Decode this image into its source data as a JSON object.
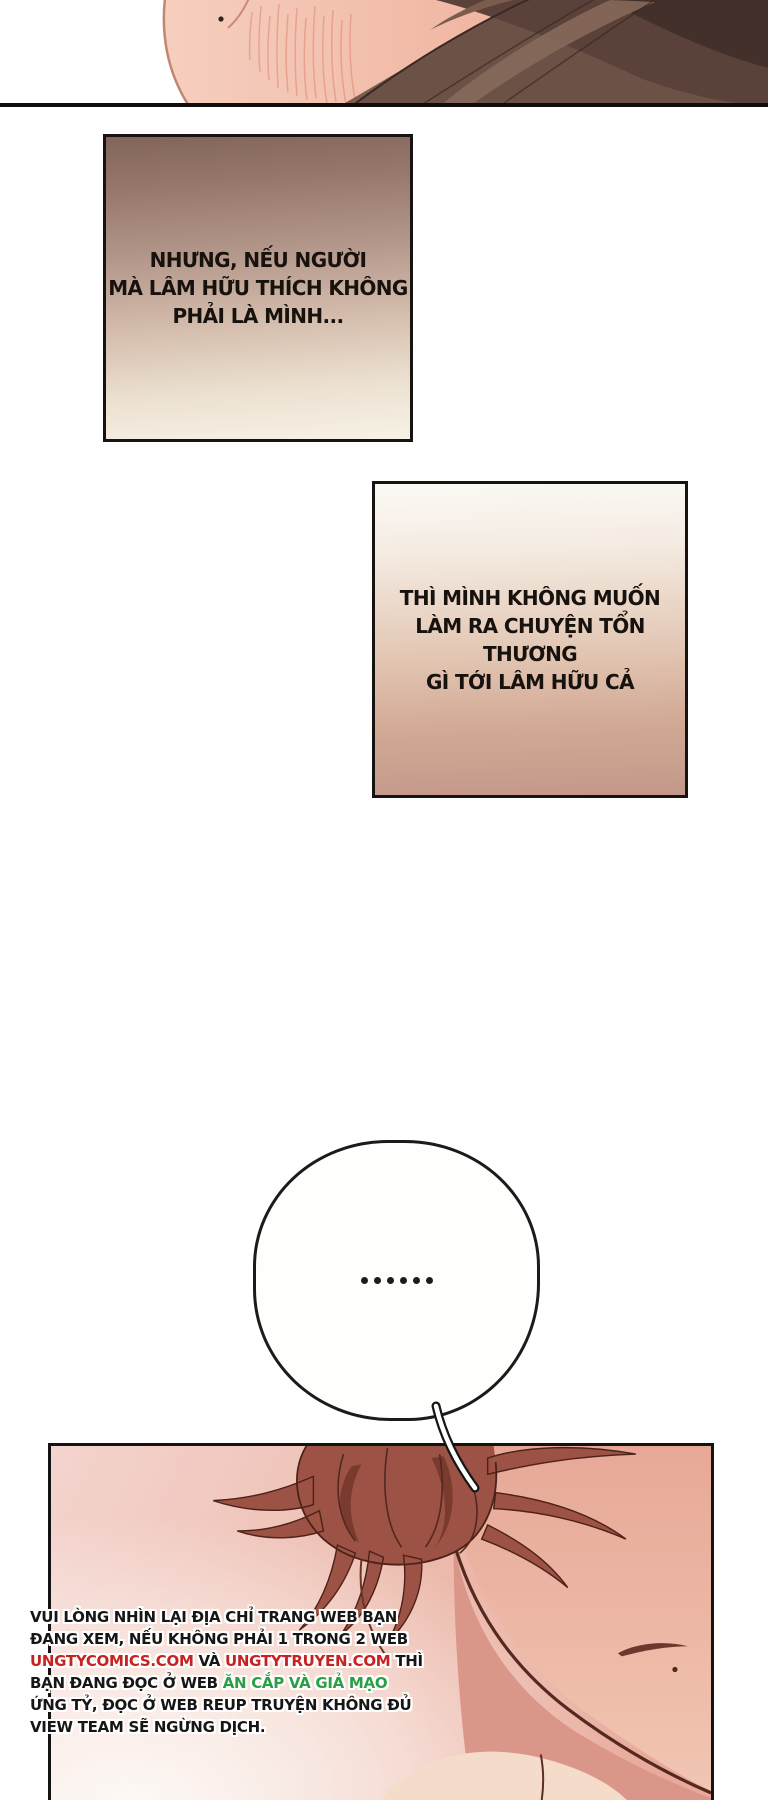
{
  "page": {
    "width": 768,
    "height": 1800,
    "background": "#ffffff",
    "type_note": "webtoon/manhua comic page"
  },
  "caption_box_1": {
    "lines": [
      "NHƯNG, NẾU NGƯỜI",
      "MÀ LÂM HỮU THÍCH KHÔNG",
      "PHẢI LÀ MÌNH..."
    ],
    "text_color": "#17120e",
    "gradient_top": "#82655a",
    "gradient_bottom": "#f7f2e6",
    "border_color": "#161310"
  },
  "caption_box_2": {
    "lines": [
      "THÌ MÌNH KHÔNG MUỐN",
      "LÀM RA CHUYỆN TỔN THƯƠNG",
      "GÌ TỚI LÂM HỮU CẢ"
    ],
    "text_color": "#17120e",
    "gradient_top": "#fbf9f5",
    "gradient_bottom": "#c3988a",
    "border_color": "#161310"
  },
  "speech_bubble": {
    "text": "......",
    "dot_color": "#1c1c1c",
    "fill": "#fefefc",
    "border_color": "#1b1b1b"
  },
  "piracy_notice": {
    "lines": [
      [
        {
          "t": "VUI LÒNG NHÌN LẠI ĐỊA CHỈ TRANG WEB BẠN",
          "c": "black"
        }
      ],
      [
        {
          "t": "ĐANG XEM, NẾU KHÔNG PHẢI 1 TRONG 2 WEB",
          "c": "black"
        }
      ],
      [
        {
          "t": "UNGTYCOMICS.COM",
          "c": "red"
        },
        {
          "t": " VÀ ",
          "c": "black"
        },
        {
          "t": "UNGTYTRUYEN.COM",
          "c": "red"
        },
        {
          "t": " THÌ",
          "c": "black"
        }
      ],
      [
        {
          "t": "BẠN ĐANG ĐỌC Ở WEB ",
          "c": "black"
        },
        {
          "t": "ĂN CẮP VÀ GIẢ MẠO",
          "c": "green"
        }
      ],
      [
        {
          "t": "ỨNG TỶ, ĐỌC Ở WEB REUP TRUYỆN KHÔNG ĐỦ",
          "c": "black"
        }
      ],
      [
        {
          "t": "VIEW TEAM SẼ NGỪNG DỊCH.",
          "c": "black"
        }
      ]
    ],
    "colors": {
      "black": "#161616",
      "red": "#c92020",
      "green": "#2a9f44"
    }
  },
  "artwork": {
    "top_band": "cropped head: skin with blush hatching at left-center, dark brown hair at right",
    "bottom_panel": "close-up of auburn-haired character's ear, cheek, jaw and neck on pink background",
    "skin_color": "#f0b5a1",
    "hair_top_color": "#5a423a",
    "hair_panel_color": "#9c5244",
    "panel_bg_color": "#eec2b8"
  }
}
